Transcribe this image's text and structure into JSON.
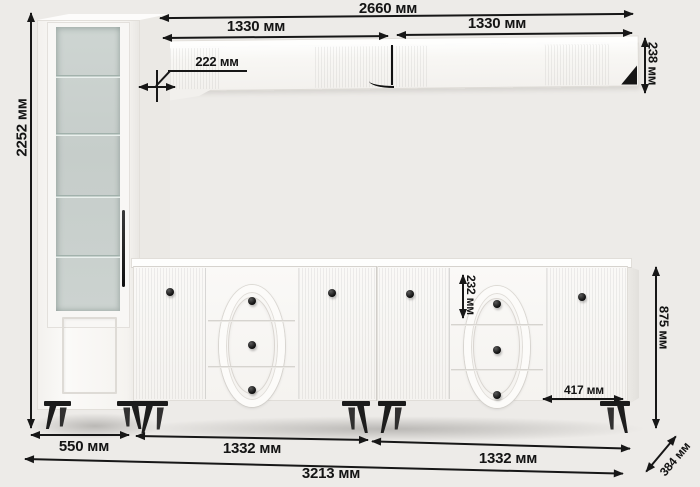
{
  "diagram": {
    "type": "furniture-dimension-drawing",
    "units": "мм",
    "dims": {
      "shelf_total": "2660 мм",
      "shelf_left": "1330 мм",
      "shelf_right": "1330 мм",
      "shelf_depth": "222 мм",
      "shelf_height": "238 мм",
      "cabinet_height": "2252 мм",
      "top_drawer_height": "232 мм",
      "sideboard_height": "875 мм",
      "drawer_bay_width": "417 мм",
      "cabinet_width": "550 мм",
      "sideboard_left_width": "1332 мм",
      "sideboard_right_width": "1332 мм",
      "total_width": "3213 мм",
      "unit_depth": "384 мм"
    },
    "colors": {
      "annotation": "#171717",
      "furniture_white": "#f9f8f6",
      "glass": "#c9d0cd",
      "hardware_black": "#1d1d1d",
      "background": "#edebe8"
    }
  }
}
